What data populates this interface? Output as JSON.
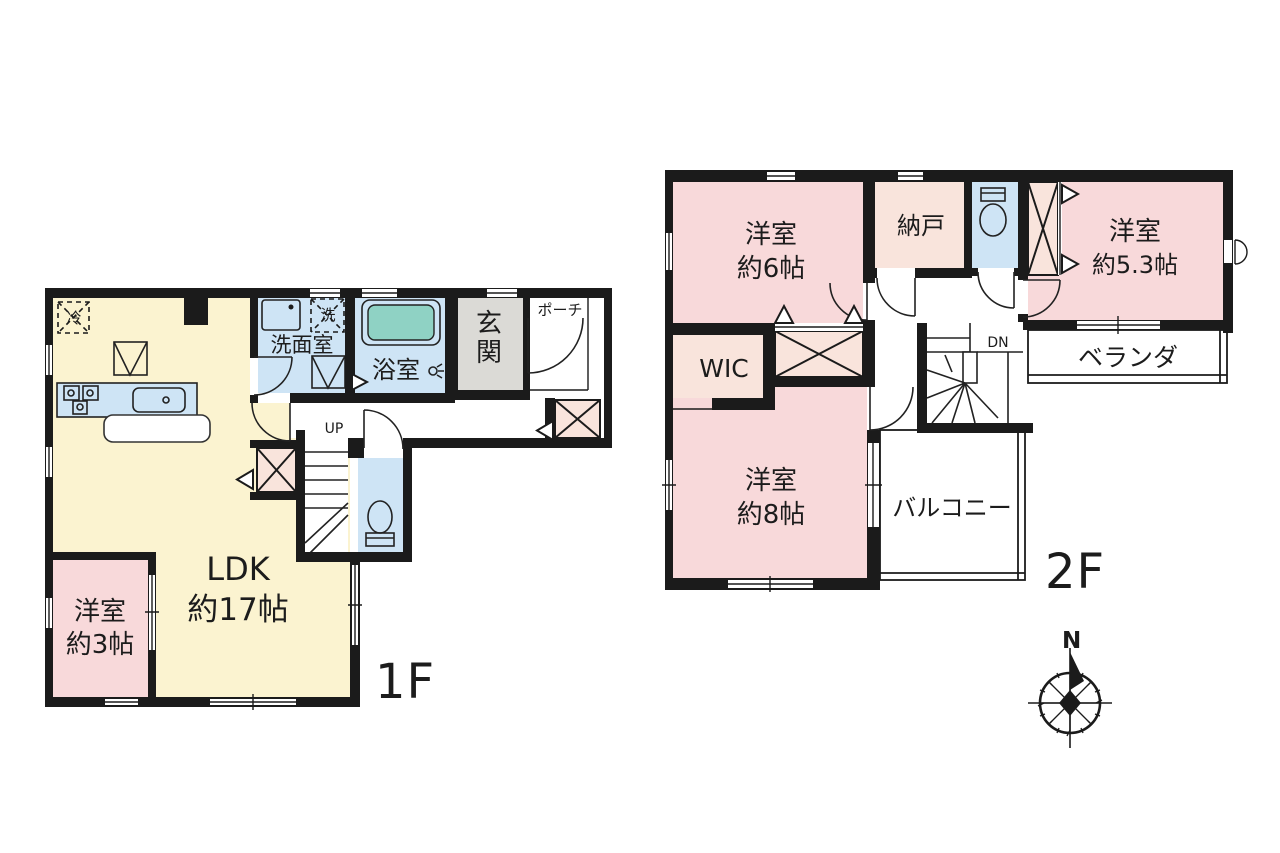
{
  "title": "間取り図",
  "colors": {
    "wall": "#1b1b1b",
    "line": "#222222",
    "room_yellow": "#fbf3d0",
    "room_pink": "#f8d9da",
    "room_cream": "#f9e4dc",
    "water_blue": "#cee4f5",
    "tub_teal": "#8fd2c4",
    "entry_gray": "#dbdad6",
    "paper_white": "#ffffff"
  },
  "floor1": {
    "label": "1F",
    "ldk": {
      "name": "LDK",
      "size": "約17帖"
    },
    "bedroom3": {
      "name": "洋室",
      "size": "約3帖"
    },
    "washroom": "洗面室",
    "bathroom": "浴室",
    "entrance": "玄関",
    "porch": "ポーチ",
    "stairs": "UP",
    "fridge": "冷",
    "laundry": "洗"
  },
  "floor2": {
    "label": "2F",
    "bedroom6": {
      "name": "洋室",
      "size": "約6帖"
    },
    "storage": "納戸",
    "bedroom53": {
      "name": "洋室",
      "size": "約5.3帖"
    },
    "wic": "WIC",
    "bedroom8": {
      "name": "洋室",
      "size": "約8帖"
    },
    "balcony": "バルコニー",
    "veranda": "ベランダ",
    "stairs": "DN"
  },
  "compass": {
    "north": "N"
  }
}
